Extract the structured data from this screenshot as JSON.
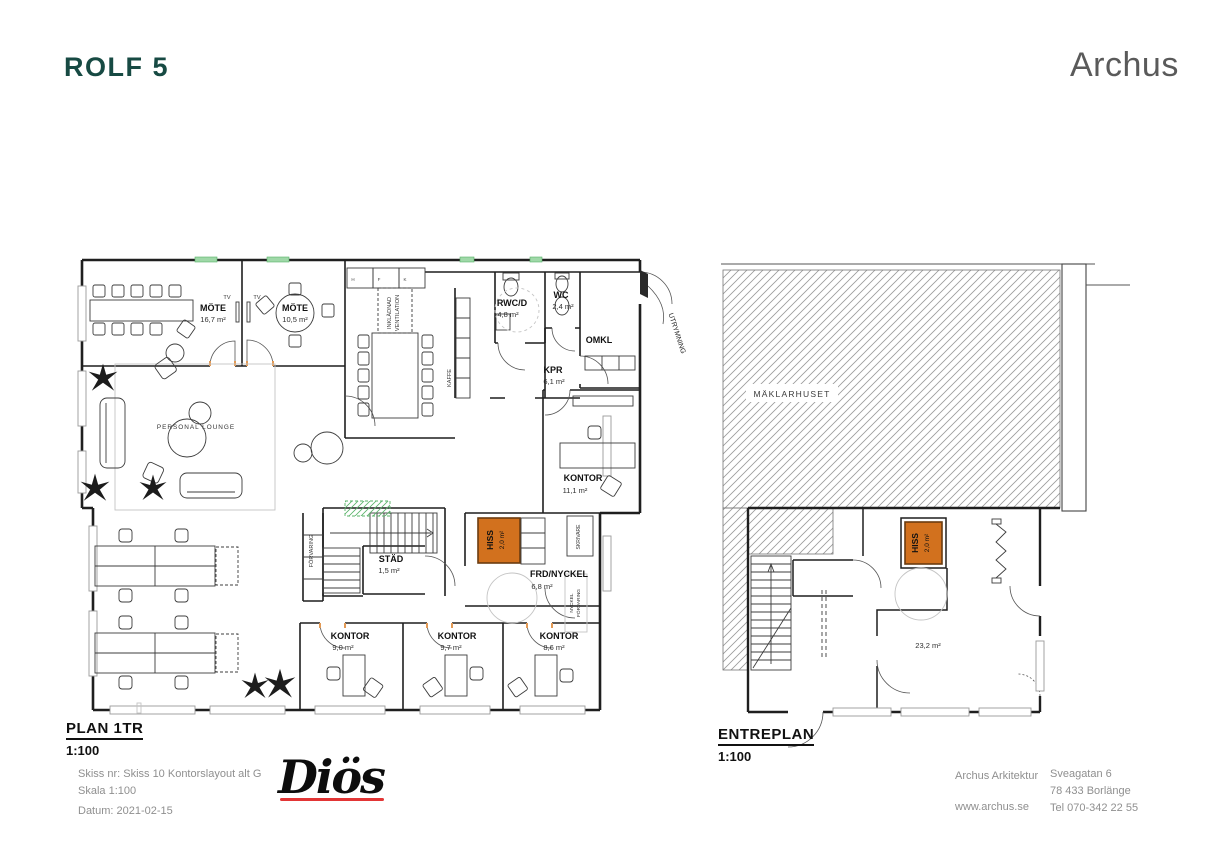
{
  "header": {
    "title": "ROLF 5",
    "brand": "Archus"
  },
  "plan1": {
    "title": "PLAN 1TR",
    "scale": "1:100",
    "rooms": {
      "mote1": {
        "name": "MÖTE",
        "area": "16,7 m²"
      },
      "mote2": {
        "name": "MÖTE",
        "area": "10,5 m²"
      },
      "rwcd": {
        "name": "RWC/D",
        "area": "4,8 m²"
      },
      "wc": {
        "name": "WC",
        "area": "2,4 m²"
      },
      "omkl": {
        "name": "OMKL"
      },
      "kpr": {
        "name": "KPR",
        "area": "6,1 m²"
      },
      "kontor11": {
        "name": "KONTOR",
        "area": "11,1 m²"
      },
      "lounge": {
        "name": "PERSONAL LOUNGE"
      },
      "stad": {
        "name": "STÄD",
        "area": "1,5 m²"
      },
      "hiss": {
        "name": "HISS",
        "area": "2,0 m²"
      },
      "frd": {
        "name": "FRD/NYCKEL",
        "area": "6,8 m²"
      },
      "kontor1": {
        "name": "KONTOR",
        "area": "9,0 m²"
      },
      "kontor2": {
        "name": "KONTOR",
        "area": "9,7 m²"
      },
      "kontor3": {
        "name": "KONTOR",
        "area": "8,6 m²"
      }
    },
    "annotations": {
      "tv1": "TV",
      "tv2": "TV",
      "kaffe": "KAFFE",
      "forvaring": "FÖRVARING",
      "inkladnad_1": "INKLÄDNAD",
      "inkladnad_2": "VENTILATION",
      "skrivare": "SKRIVARE",
      "nyckel_1": "NYCKEL",
      "nyckel_2": "FÖRVARING",
      "utrymning": "UTRYMNING"
    },
    "cabinets": [
      "H",
      "F",
      "K"
    ]
  },
  "plan2": {
    "title": "ENTREPLAN",
    "scale": "1:100",
    "rooms": {
      "maklarhuset": {
        "name": "MÄKLARHUSET"
      },
      "hiss": {
        "name": "HISS",
        "area": "2,0 m²"
      },
      "entre": {
        "area": "23,2 m²"
      }
    }
  },
  "titleblock": {
    "sketch": "Skiss nr: Skiss 10 Kontorslayout alt G",
    "scale": "Skala 1:100",
    "date": "Datum: 2021-02-15",
    "logo": "Diös",
    "firm": "Archus Arkitektur",
    "web": "www.archus.se",
    "address1": "Sveagatan 6",
    "address2": "78 433 Borlänge",
    "phone": "Tel 070-342 22 55"
  },
  "colors": {
    "accent_teal": "#174a43",
    "brand_gray": "#5a5a5a",
    "hiss_fill": "#d2711e",
    "hiss_stroke": "#6b3c10",
    "logo_red": "#e23535",
    "muted_gray": "#8f8f8f",
    "window_green": "#58b368",
    "jamb_orange": "#e39a55"
  }
}
